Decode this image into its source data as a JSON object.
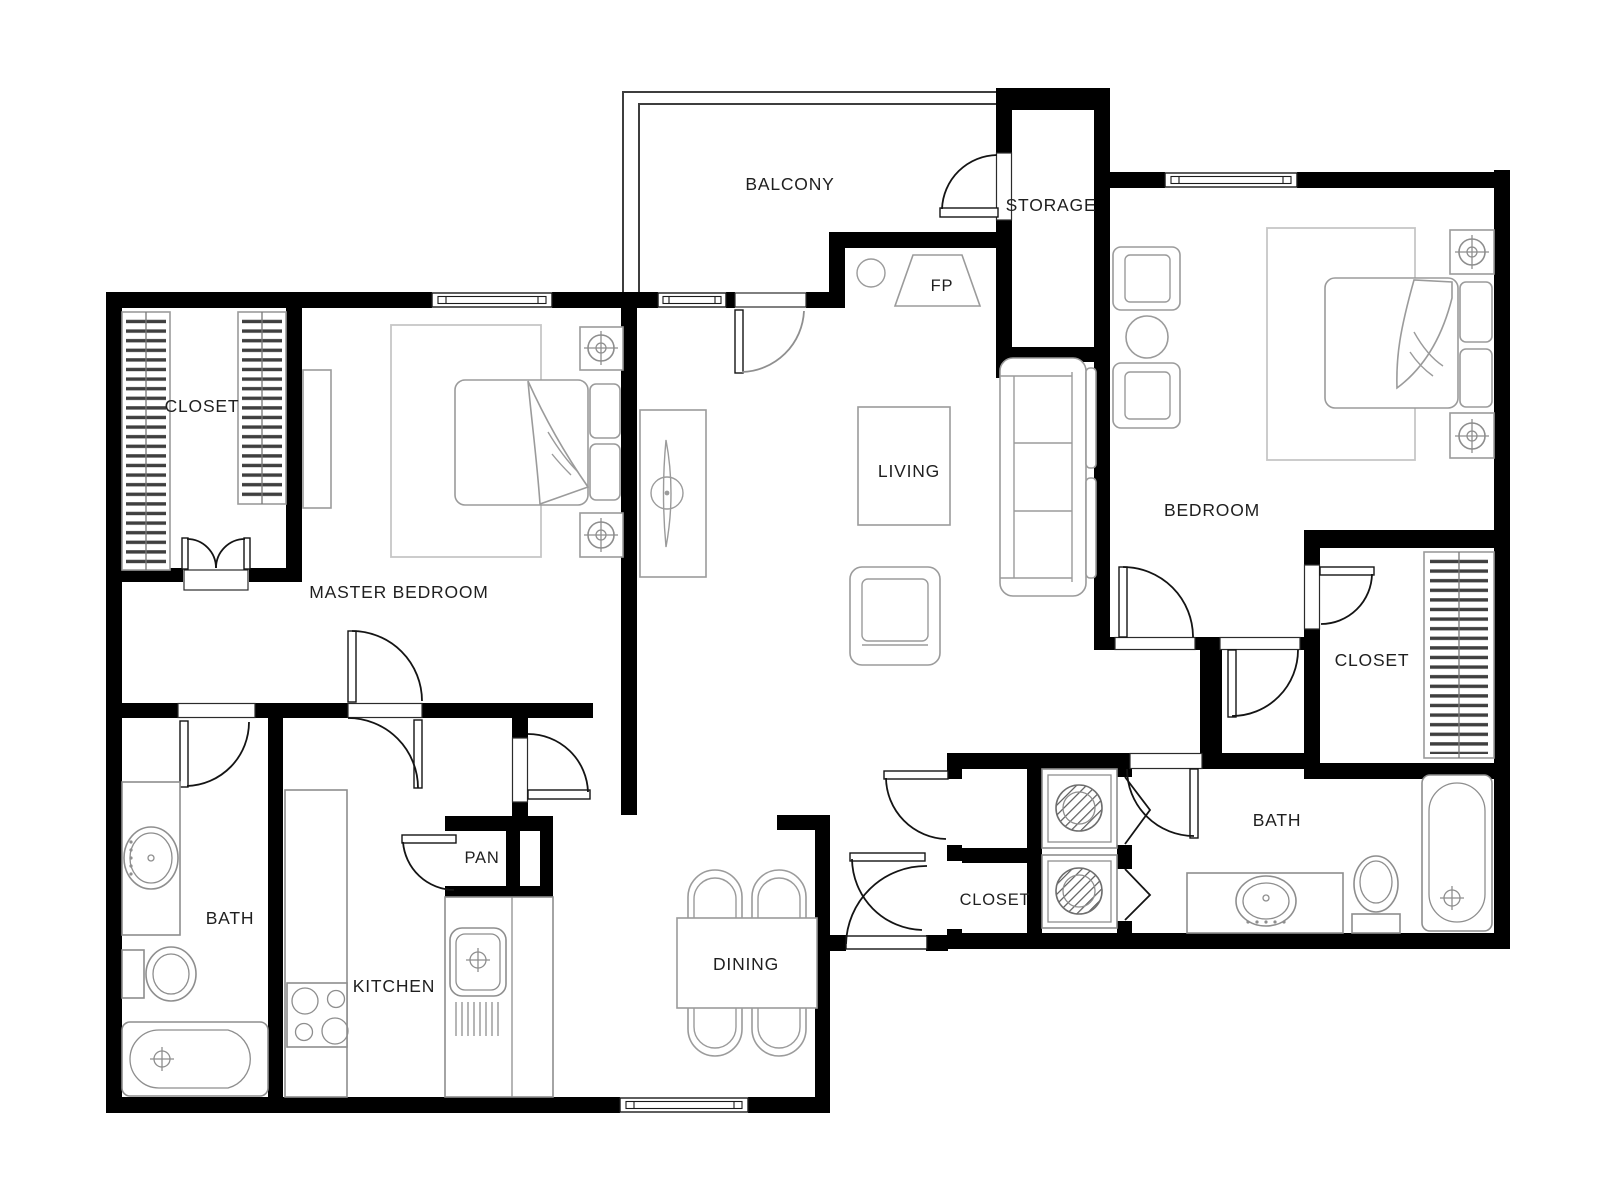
{
  "plan": {
    "type": "apartment-floor-plan",
    "colors": {
      "wall": "#000000",
      "furniture_line": "#9b9b9b",
      "door_line": "#141414",
      "rug_line": "#c6c6c6",
      "background": "#ffffff"
    },
    "rooms": [
      {
        "id": "balcony",
        "label": "BALCONY"
      },
      {
        "id": "storage",
        "label": "STORAGE"
      },
      {
        "id": "fireplace",
        "label": "FP"
      },
      {
        "id": "living",
        "label": "LIVING"
      },
      {
        "id": "bedroom",
        "label": "BEDROOM"
      },
      {
        "id": "master-closet",
        "label": "CLOSET"
      },
      {
        "id": "master-bedroom",
        "label": "MASTER BEDROOM"
      },
      {
        "id": "bedroom-closet",
        "label": "CLOSET"
      },
      {
        "id": "master-bath",
        "label": "BATH"
      },
      {
        "id": "pantry",
        "label": "PAN"
      },
      {
        "id": "kitchen",
        "label": "KITCHEN"
      },
      {
        "id": "dining",
        "label": "DINING"
      },
      {
        "id": "hall-closet",
        "label": "CLOSET"
      },
      {
        "id": "bath",
        "label": "BATH"
      }
    ]
  }
}
